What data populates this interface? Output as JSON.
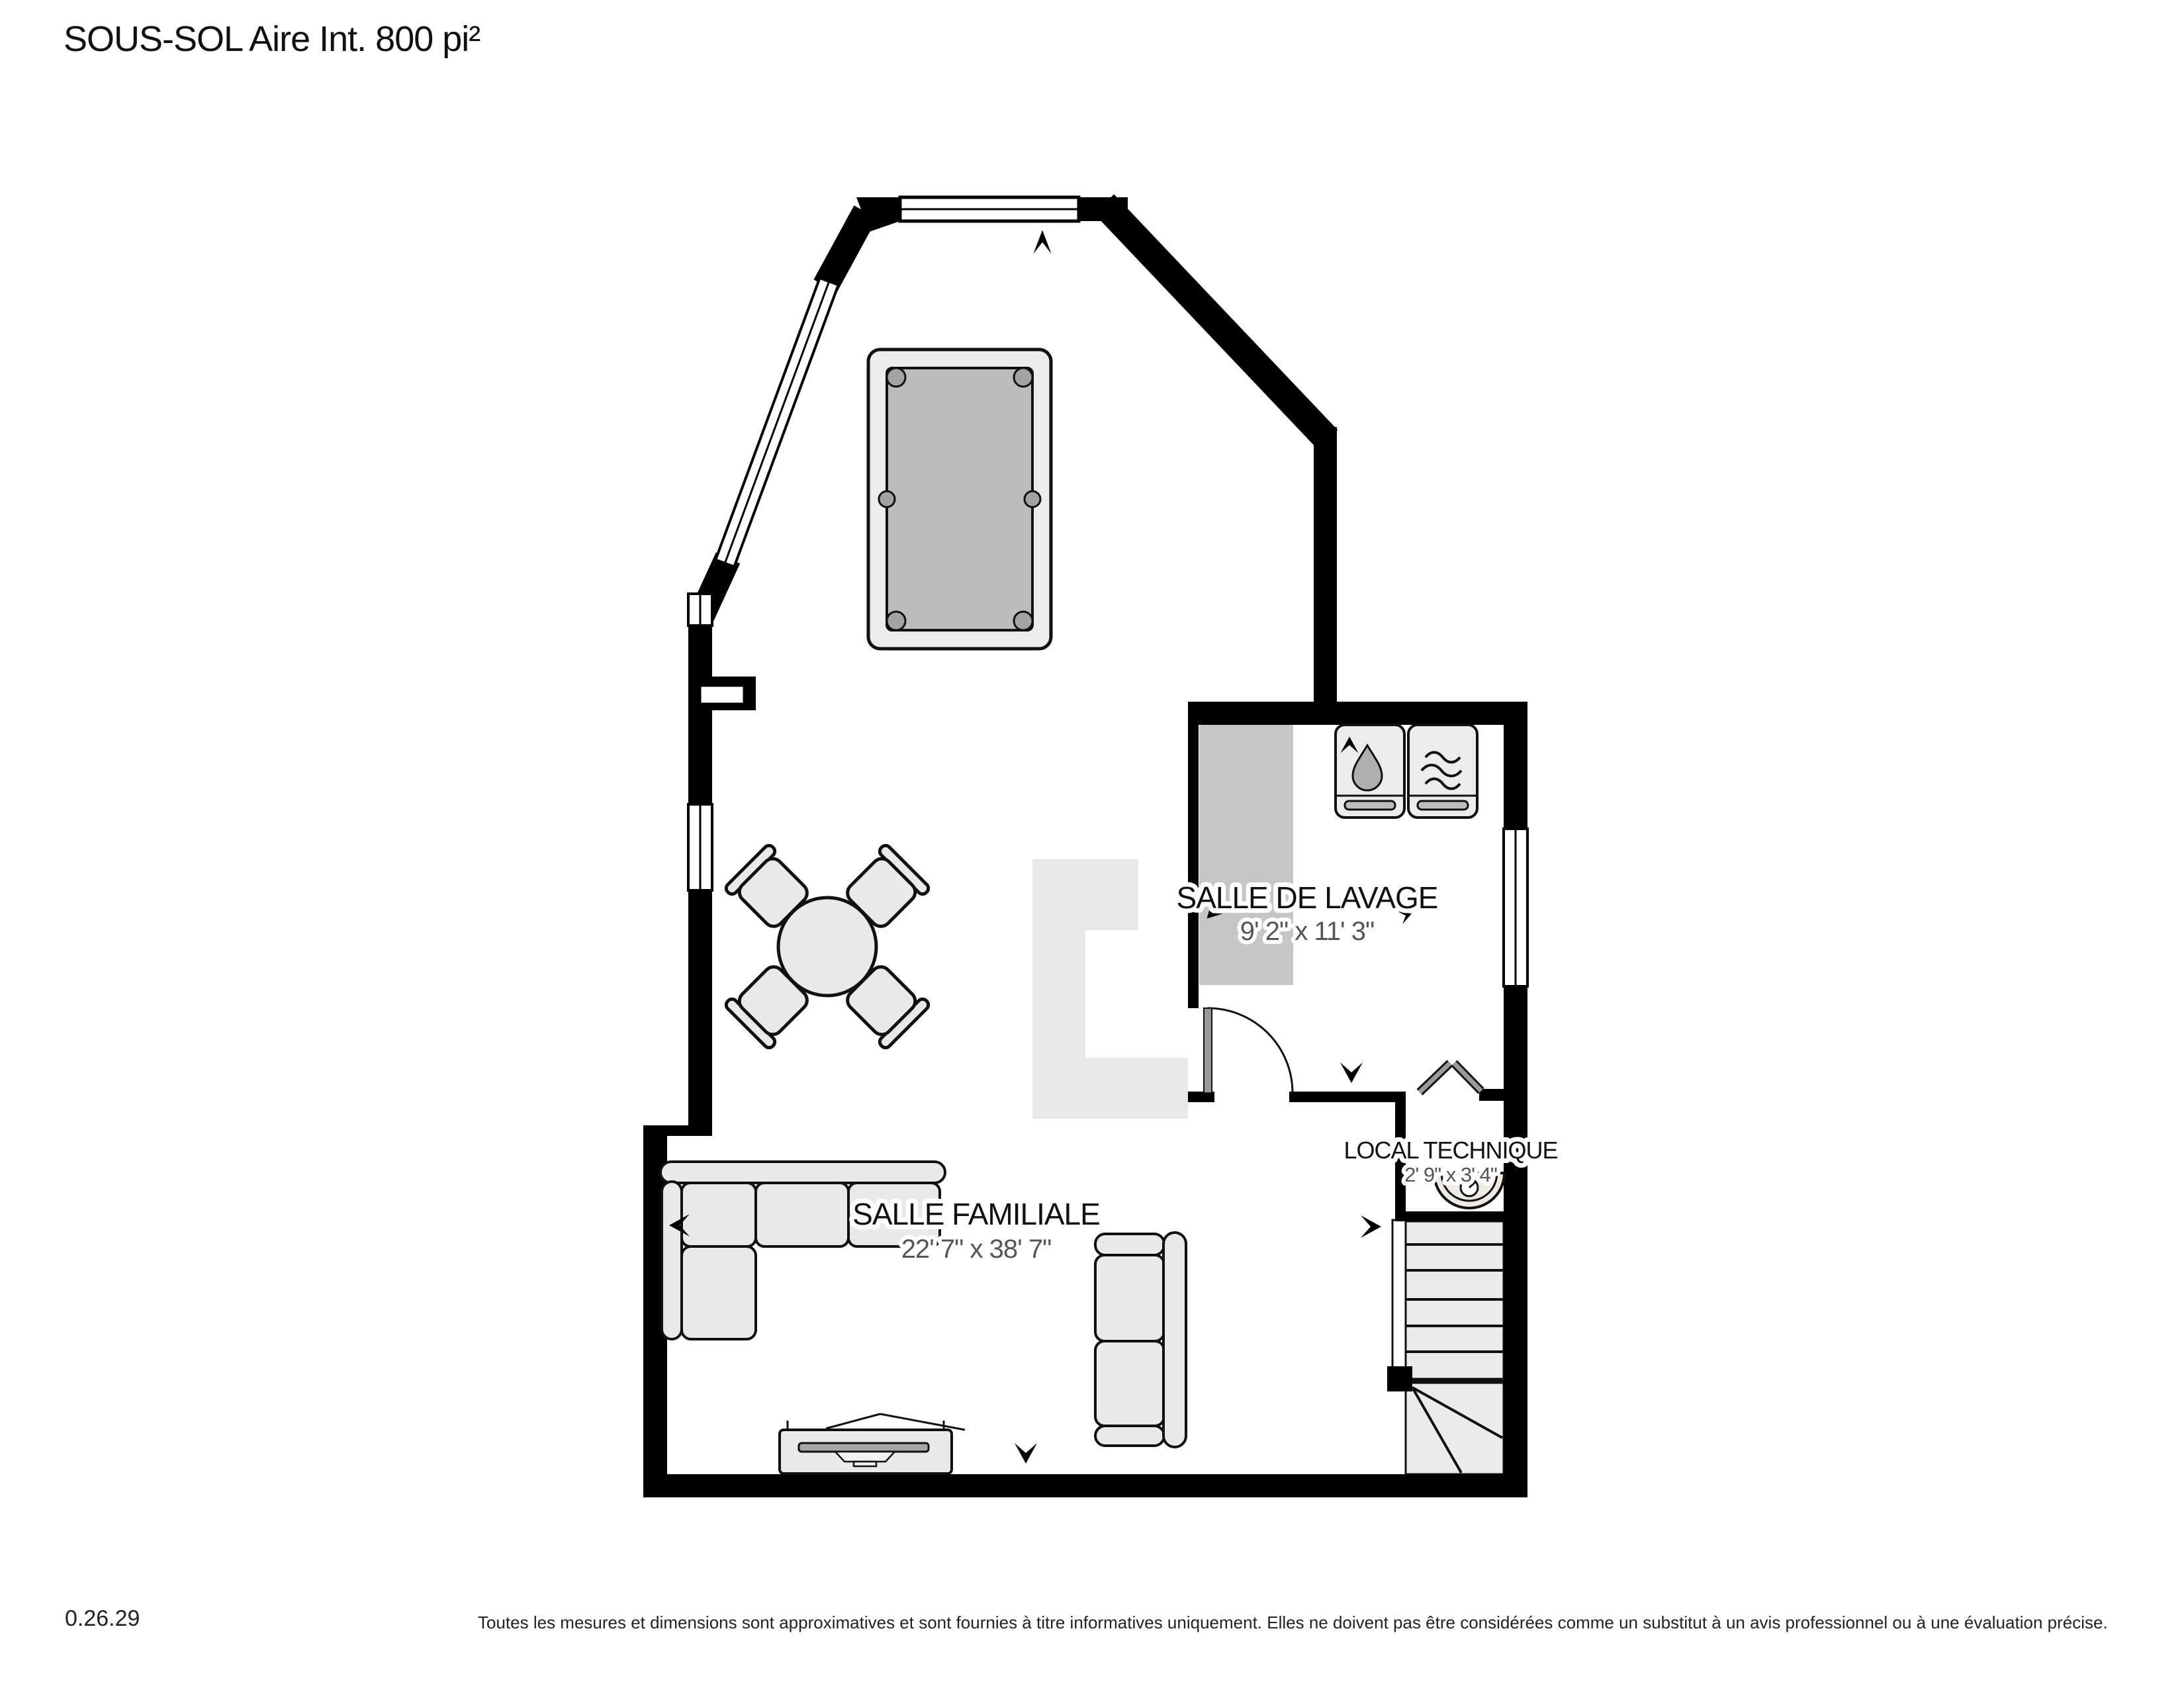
{
  "page": {
    "title": "SOUS-SOL Aire Int. 800 pi²",
    "version": "0.26.29",
    "disclaimer": "Toutes les mesures et dimensions sont approximatives et sont fournies à titre informatives uniquement. Elles ne doivent pas être considérées comme un substitut à un avis professionnel ou à une évaluation précise."
  },
  "rooms": {
    "salle_familiale": {
      "name": "SALLE FAMILIALE",
      "dimensions": "22' 7\" x 38' 7\""
    },
    "salle_de_lavage": {
      "name": "SALLE DE LAVAGE",
      "dimensions": "9' 2\" x 11' 3\""
    },
    "local_technique": {
      "name": "LOCAL TECHNIQUE",
      "dimensions": "2' 9\" x 3' 4\""
    }
  },
  "furniture_icons": [
    "pool-table-icon",
    "dining-table-icon",
    "chair-icon",
    "sectional-sofa-icon",
    "loveseat-icon",
    "tv-stand-icon",
    "washer-icon",
    "dryer-icon",
    "water-heater-icon",
    "stairs-icon",
    "door-swing-icon",
    "bifold-door-icon",
    "direction-arrow-icon",
    "window-icon"
  ],
  "colors": {
    "wall": "#000000",
    "furniture_fill": "#ebebeb",
    "pool_table_felt": "#bcbcbc",
    "laundry_counter_gray": "#c6c6c6",
    "floor_area_gray": "#e8e8e8",
    "dimension_text": "#555555"
  }
}
